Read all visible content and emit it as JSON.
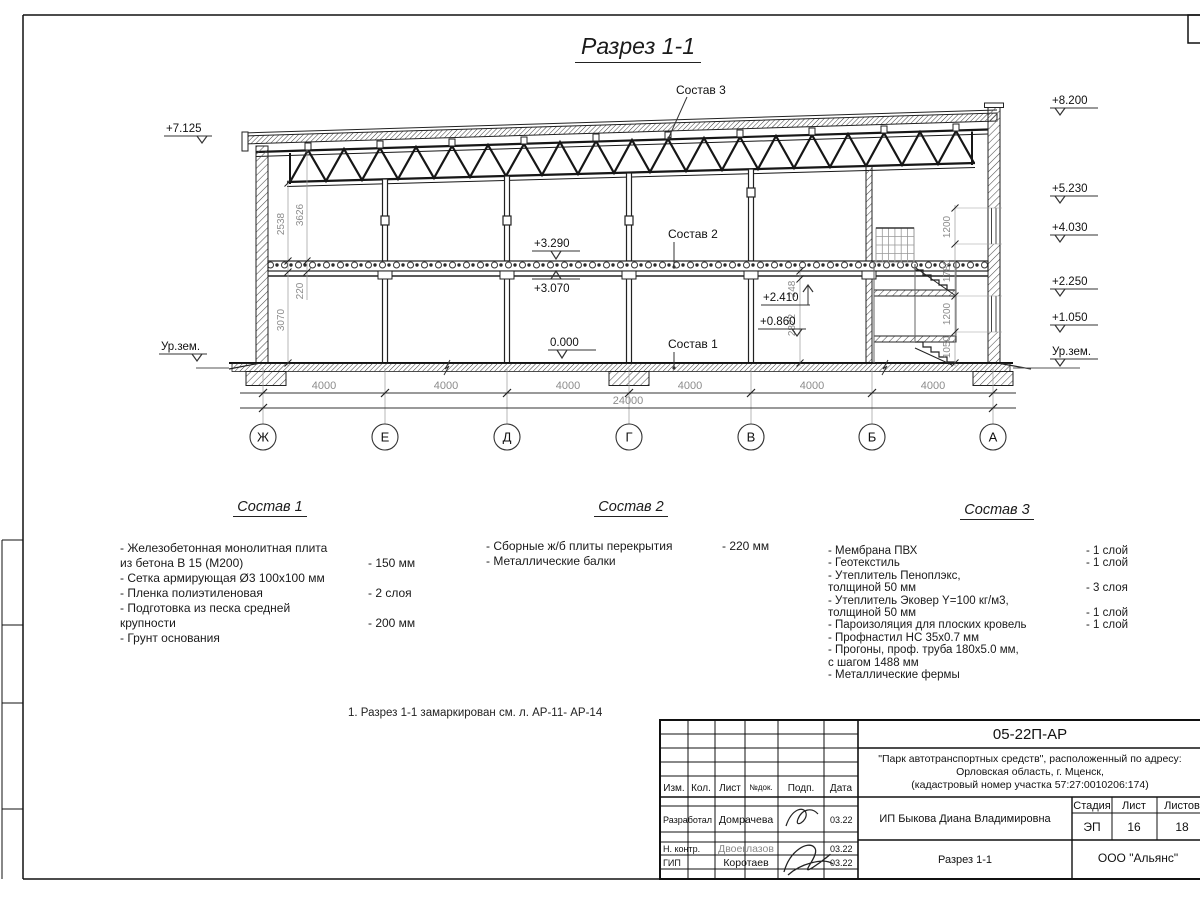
{
  "sheet": {
    "title": "Разрез 1-1",
    "note": "1. Разрез 1-1 замаркирован см. л. АР-11- АР-14"
  },
  "drawing": {
    "axes": [
      "Ж",
      "Е",
      "Д",
      "Г",
      "В",
      "Б",
      "А"
    ],
    "span_dims": [
      "4000",
      "4000",
      "4000",
      "4000",
      "4000",
      "4000"
    ],
    "total_dim": "24000",
    "elev": {
      "left_top": "+7.125",
      "ground_left": "Ур.зем.",
      "right_top": "+8.200",
      "right_1": "+5.230",
      "right_2": "+4.030",
      "right_3": "+2.250",
      "right_4": "+1.050",
      "ground_right": "Ур.зем.",
      "slab_top": "+3.290",
      "slab_bottom": "+3.070",
      "floor": "0.000",
      "stair_upper": "+2.410",
      "stair_lower": "+0.860"
    },
    "vdims": {
      "v2538": "2538",
      "v3626": "3626",
      "v220": "220",
      "v3070": "3070",
      "v248": "248",
      "v2822": "2822",
      "r1200a": "1200",
      "r1780": "1780",
      "r1200b": "1200",
      "r1050": "1050"
    },
    "leaders": {
      "l3": "Состав 3",
      "l2": "Состав 2",
      "l1": "Состав 1"
    }
  },
  "compositions": [
    {
      "title": "Состав 1",
      "items": [
        {
          "t": "- Железобетонная  монолитная плита\nиз бетона В 15 (М200)",
          "v": "- 150 мм"
        },
        {
          "t": "- Сетка армирующая Ø3 100х100 мм",
          "v": ""
        },
        {
          "t": "- Пленка полиэтиленовая",
          "v": "- 2 слоя"
        },
        {
          "t": "- Подготовка из песка средней\nкрупности",
          "v": "- 200 мм"
        },
        {
          "t": "- Грунт основания",
          "v": ""
        }
      ]
    },
    {
      "title": "Состав 2",
      "items": [
        {
          "t": "- Сборные ж/б плиты перекрытия",
          "v": "- 220 мм"
        },
        {
          "t": "- Металлические балки",
          "v": ""
        }
      ]
    },
    {
      "title": "Состав 3",
      "items": [
        {
          "t": "- Мембрана ПВХ",
          "v": "- 1 слой"
        },
        {
          "t": "- Геотекстиль",
          "v": "- 1 слой"
        },
        {
          "t": "- Утеплитель Пеноплэкс,\nтолщиной 50 мм",
          "v": "- 3 слоя"
        },
        {
          "t": "- Утеплитель Эковер Y=100 кг/м3,\nтолщиной 50 мм",
          "v": "- 1 слой"
        },
        {
          "t": "- Пароизоляция для плоских кровель",
          "v": "- 1 слой"
        },
        {
          "t": "- Профнастил НС 35х0.7 мм",
          "v": ""
        },
        {
          "t": "- Прогоны, проф. труба 180х5.0 мм,\nс шагом 1488 мм",
          "v": ""
        },
        {
          "t": "- Металлические фермы",
          "v": ""
        }
      ]
    }
  ],
  "titleblock": {
    "doc_code": "05-22П-АР",
    "project_lines": [
      "\"Парк автотранспортных средств\",  расположенный по адресу:",
      "Орловская область, г. Мценск,",
      "(кадастровый номер участка 57:27:0010206:174)"
    ],
    "client": "ИП Быкова Диана Владимировна",
    "sheet_title": "Разрез 1-1",
    "company": "ООО \"Альянс\"",
    "headers": {
      "izm": "Изм.",
      "kol": "Кол.",
      "list": "Лист",
      "ndok": "№док.",
      "podp": "Подп.",
      "data": "Дата",
      "stage": "Стадия",
      "sheet": "Лист",
      "sheets": "Листов"
    },
    "stage": "ЭП",
    "sheet_no": "16",
    "sheets_total": "18",
    "rows": [
      {
        "role": "Разработал",
        "name": "Домрачева",
        "date": "03.22"
      },
      {
        "role": "Н. контр.",
        "name": "Двоеглазов",
        "date": "03.22"
      },
      {
        "role": "ГИП",
        "name": "Коротаев",
        "date": "03.22"
      }
    ]
  }
}
